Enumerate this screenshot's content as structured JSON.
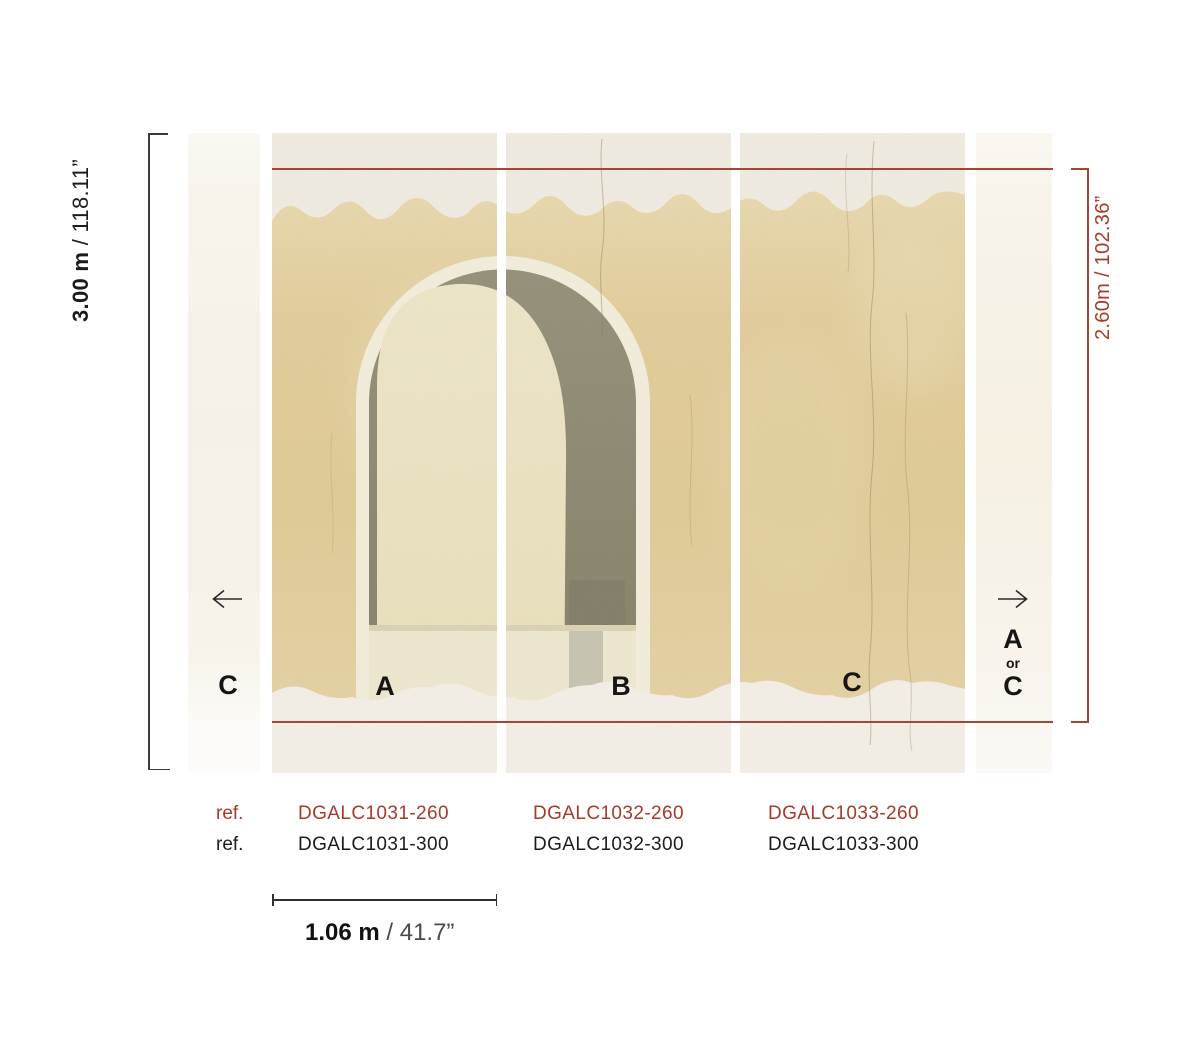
{
  "dimensions": {
    "height_300": {
      "value": "3.00 m",
      "inches": " / 118.11”"
    },
    "height_260": {
      "value": "2.60m",
      "inches": " / 102.36”"
    },
    "width_panel": {
      "value": "1.06 m",
      "inches": " / 41.7”"
    }
  },
  "panel_labels": {
    "left_partial": "C",
    "panel_a": "A",
    "panel_b": "B",
    "panel_c": "C",
    "right_partial_top": "A",
    "right_partial_or": "or",
    "right_partial_bottom": "C"
  },
  "refs": {
    "label_260": "ref.",
    "label_300": "ref.",
    "codes_260": [
      "DGALC1031-260",
      "DGALC1032-260",
      "DGALC1033-260"
    ],
    "codes_300": [
      "DGALC1031-300",
      "DGALC1032-300",
      "DGALC1033-300"
    ]
  },
  "icons": {
    "left_arrow": "left-arrow",
    "right_arrow": "right-arrow"
  },
  "colors": {
    "accent_red_text": "#a63b2a",
    "accent_red_line": "#9e4836",
    "mural_tan": "#e0cb97",
    "mural_olive": "#8f8a74",
    "mural_cream": "#f1ece2"
  }
}
